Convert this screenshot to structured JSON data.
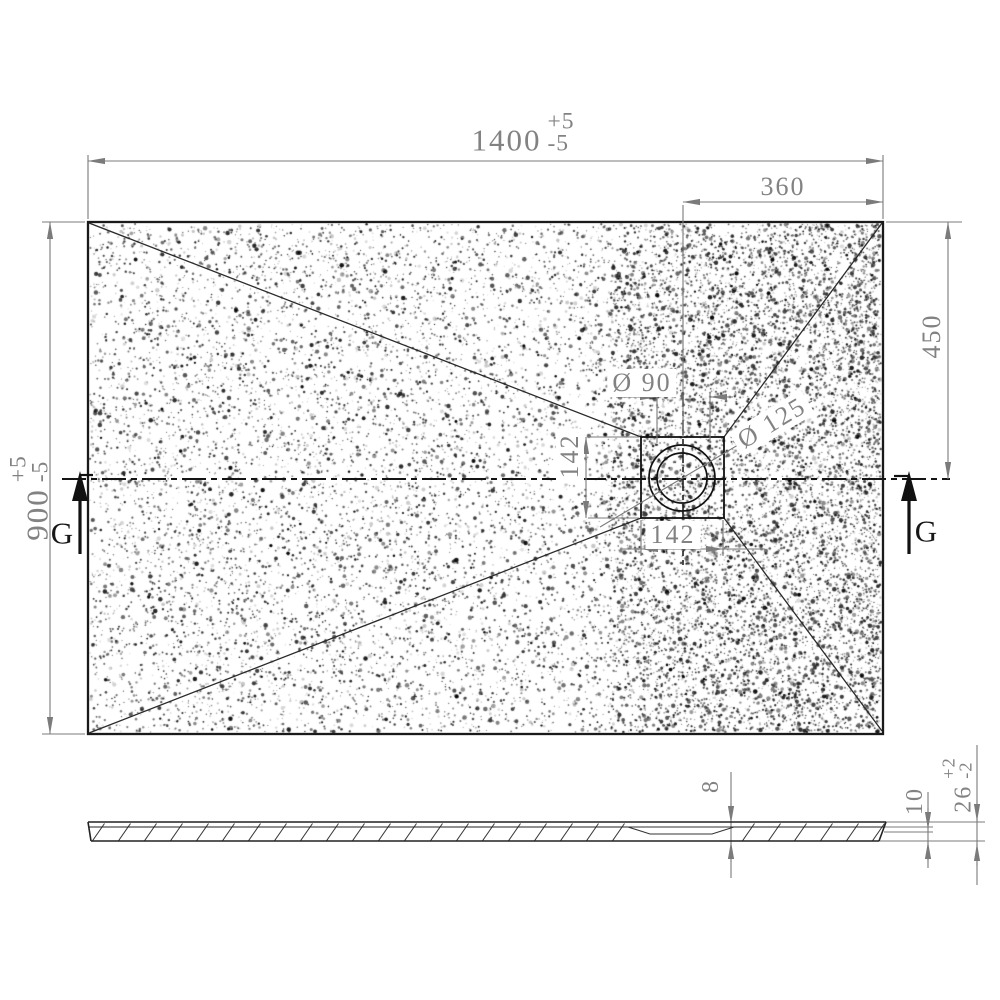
{
  "plan_view": {
    "length": {
      "value": "1400",
      "plus": "+5",
      "minus": "-5"
    },
    "width": {
      "value": "900",
      "plus": "+5",
      "minus": "-5"
    },
    "drain_center_from_right": "360",
    "drain_center_from_top": "450",
    "drain_recess_width": "142",
    "drain_recess_height": "142",
    "waste_hole_dia": "Ø 90",
    "flange_dia": "Ø 125",
    "section_label": "G"
  },
  "section_view": {
    "thickness_at_drain": "8",
    "thickness_at_edge": "10",
    "edge_height": {
      "value": "26",
      "plus": "+2",
      "minus": "-2"
    }
  }
}
